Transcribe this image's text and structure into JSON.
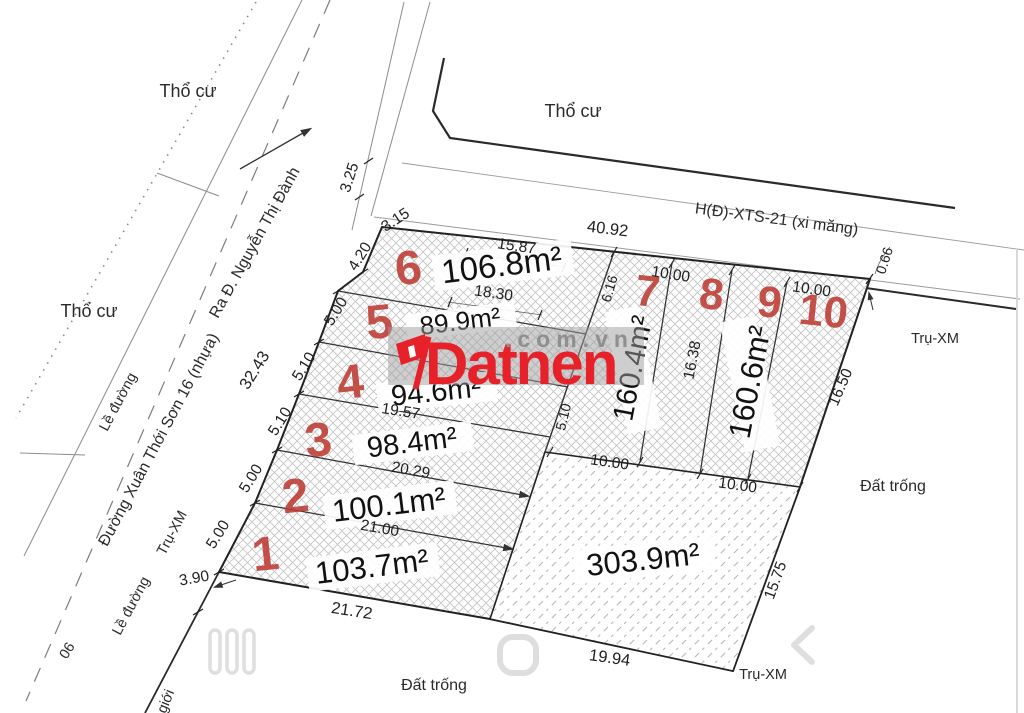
{
  "region_labels": {
    "tho_cu": "Thổ cư",
    "dat_trong": "Đất trống"
  },
  "roads": {
    "left_road_name": "Đường Xuân Thới Sơn 16 (nhựa)",
    "left_road_exit": "Ra Đ. Nguyễn Thị Đành",
    "shoulder": "Lề đường",
    "top_road_name": "H(Đ)-XTS-21 (xi măng)",
    "post": "Trụ-XM",
    "boundary_fragment": "giới",
    "corner_note": "06"
  },
  "plots": [
    {
      "number": "1",
      "area": "103.7m²"
    },
    {
      "number": "2",
      "area": "100.1m²"
    },
    {
      "number": "3",
      "area": "98.4m²"
    },
    {
      "number": "4",
      "area": "94.6m²"
    },
    {
      "number": "5",
      "area": "89.9m²"
    },
    {
      "number": "6",
      "area": "106.8m²"
    },
    {
      "number": "7",
      "area": "160.4m²"
    },
    {
      "number": "8",
      "area": ""
    },
    {
      "number": "9",
      "area": "160.6m²"
    },
    {
      "number": "10",
      "area": ""
    }
  ],
  "big_plot": {
    "area": "303.9m²"
  },
  "dims": {
    "front": [
      "3.25",
      "3.15",
      "4.20",
      "5.00",
      "5.10",
      "5.10",
      "5.00",
      "5.00",
      "3.90"
    ],
    "road_total": "32.43",
    "top_total": "40.92",
    "lot_lengths": [
      "21.72",
      "21.00",
      "20.29",
      "19.57",
      "18.30",
      "15.87"
    ],
    "block_widths_top": [
      "10.00",
      "10.00"
    ],
    "block_widths_bottom": [
      "10.00",
      "10.00"
    ],
    "block_depths": {
      "d616": "6.16",
      "d510": "5.10",
      "d1638": "16.38",
      "d1650": "16.50",
      "d1575": "15.75"
    },
    "big_bottom": "19.94",
    "corner_offset": "0.66"
  },
  "watermark": {
    "brand": "Datnen",
    "suffix": ".com.vn"
  }
}
